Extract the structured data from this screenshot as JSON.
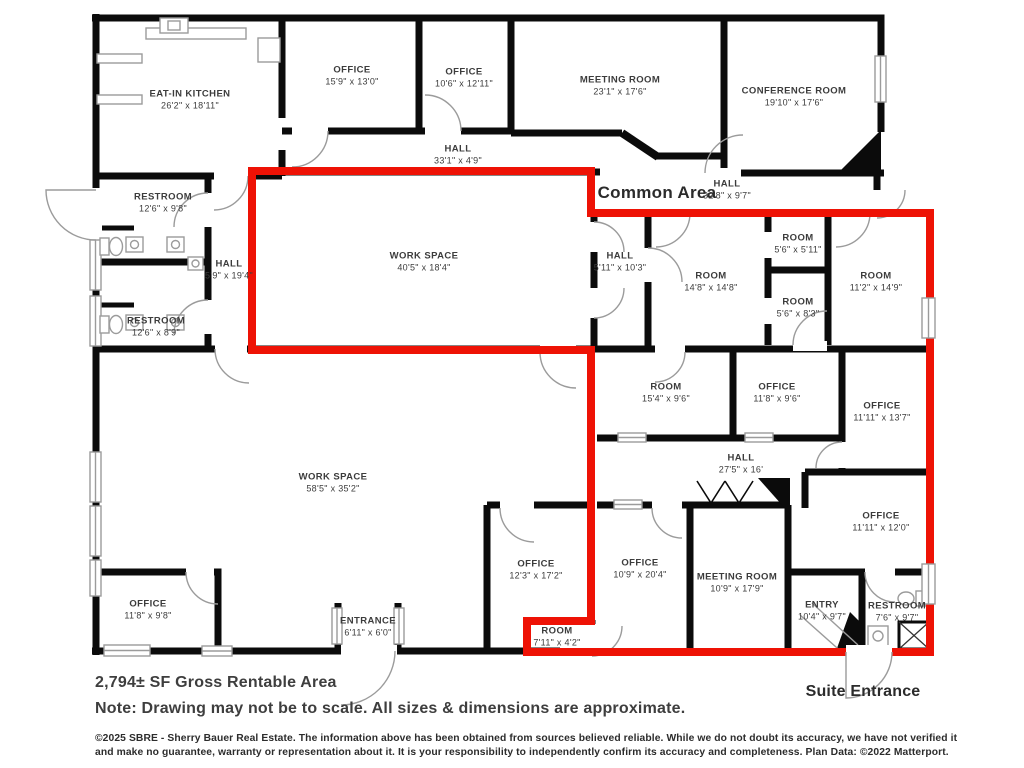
{
  "plan": {
    "colors": {
      "wall": "#0b0b0b",
      "suite_outline": "#ee1205",
      "fixture": "#9b9b9b",
      "label_text": "#3c3c3c"
    },
    "common_area_label": "Common Area",
    "suite_entrance_label": "Suite Entrance",
    "rooms": [
      {
        "id": "eat-in-kitchen",
        "name": "EAT-IN KITCHEN",
        "dims": "26'2\" x 18'11\"",
        "x": 190,
        "y": 100
      },
      {
        "id": "office-top-1",
        "name": "OFFICE",
        "dims": "15'9\" x 13'0\"",
        "x": 352,
        "y": 76
      },
      {
        "id": "office-top-2",
        "name": "OFFICE",
        "dims": "10'6\" x 12'11\"",
        "x": 464,
        "y": 78
      },
      {
        "id": "meeting-room-top",
        "name": "MEETING ROOM",
        "dims": "23'1\" x 17'6\"",
        "x": 620,
        "y": 86
      },
      {
        "id": "conference-room",
        "name": "CONFERENCE ROOM",
        "dims": "19'10\" x 17'6\"",
        "x": 794,
        "y": 97
      },
      {
        "id": "hall-top",
        "name": "HALL",
        "dims": "33'1\" x 4'9\"",
        "x": 458,
        "y": 155
      },
      {
        "id": "hall-common",
        "name": "HALL",
        "dims": "32'8\" x 9'7\"",
        "x": 727,
        "y": 190
      },
      {
        "id": "restroom-upper",
        "name": "RESTROOM",
        "dims": "12'6\" x 9'8\"",
        "x": 163,
        "y": 203
      },
      {
        "id": "hall-left",
        "name": "HALL",
        "dims": "5'9\" x 19'4\"",
        "x": 229,
        "y": 270
      },
      {
        "id": "restroom-lower",
        "name": "RESTROOM",
        "dims": "12'6\" x 8'9\"",
        "x": 156,
        "y": 327
      },
      {
        "id": "work-space-suite",
        "name": "WORK SPACE",
        "dims": "40'5\" x 18'4\"",
        "x": 424,
        "y": 262
      },
      {
        "id": "hall-suite",
        "name": "HALL",
        "dims": "5'11\" x 10'3\"",
        "x": 620,
        "y": 262
      },
      {
        "id": "room-small-1",
        "name": "ROOM",
        "dims": "5'6\" x 5'11\"",
        "x": 798,
        "y": 244
      },
      {
        "id": "room-14x14",
        "name": "ROOM",
        "dims": "14'8\" x 14'8\"",
        "x": 711,
        "y": 282
      },
      {
        "id": "room-small-2",
        "name": "ROOM",
        "dims": "5'6\" x 8'3\"",
        "x": 798,
        "y": 308
      },
      {
        "id": "room-11x14",
        "name": "ROOM",
        "dims": "11'2\" x 14'9\"",
        "x": 876,
        "y": 282
      },
      {
        "id": "room-15x9",
        "name": "ROOM",
        "dims": "15'4\" x 9'6\"",
        "x": 666,
        "y": 393
      },
      {
        "id": "office-11x9",
        "name": "OFFICE",
        "dims": "11'8\" x 9'6\"",
        "x": 777,
        "y": 393
      },
      {
        "id": "office-11x13",
        "name": "OFFICE",
        "dims": "11'11\" x 13'7\"",
        "x": 882,
        "y": 412
      },
      {
        "id": "work-space-main",
        "name": "WORK SPACE",
        "dims": "58'5\" x 35'2\"",
        "x": 333,
        "y": 483
      },
      {
        "id": "hall-lower",
        "name": "HALL",
        "dims": "27'5\" x 16'",
        "x": 741,
        "y": 464
      },
      {
        "id": "office-12x17",
        "name": "OFFICE",
        "dims": "12'3\" x 17'2\"",
        "x": 536,
        "y": 570
      },
      {
        "id": "room-7x4",
        "name": "ROOM",
        "dims": "7'11\" x 4'2\"",
        "x": 557,
        "y": 637
      },
      {
        "id": "office-10x20",
        "name": "OFFICE",
        "dims": "10'9\" x 20'4\"",
        "x": 640,
        "y": 569
      },
      {
        "id": "meeting-room-lower",
        "name": "MEETING ROOM",
        "dims": "10'9\" x 17'9\"",
        "x": 737,
        "y": 583
      },
      {
        "id": "office-11x12",
        "name": "OFFICE",
        "dims": "11'11\" x 12'0\"",
        "x": 881,
        "y": 522
      },
      {
        "id": "entry",
        "name": "ENTRY",
        "dims": "10'4\" x 9'7\"",
        "x": 822,
        "y": 611
      },
      {
        "id": "restroom-suite",
        "name": "RESTROOM",
        "dims": "7'6\" x 9'7\"",
        "x": 897,
        "y": 612
      },
      {
        "id": "office-11x9-bl",
        "name": "OFFICE",
        "dims": "11'8\" x 9'8\"",
        "x": 148,
        "y": 610
      },
      {
        "id": "entrance",
        "name": "ENTRANCE",
        "dims": "6'11\" x 6'0\"",
        "x": 368,
        "y": 627
      }
    ],
    "footer": {
      "gross_area": "2,794± SF Gross Rentable Area",
      "note": "Note: Drawing may not be to scale. All sizes & dimensions are approximate.",
      "disclaimer_line1": "©2025 SBRE - Sherry Bauer Real Estate. The information above has been obtained from sources believed reliable. While we do not doubt its accuracy, we have not verified it",
      "disclaimer_line2": "and make no guarantee, warranty or representation about it. It is your responsibility to independently confirm its accuracy and completeness. Plan Data: ©2022 Matterport."
    }
  }
}
